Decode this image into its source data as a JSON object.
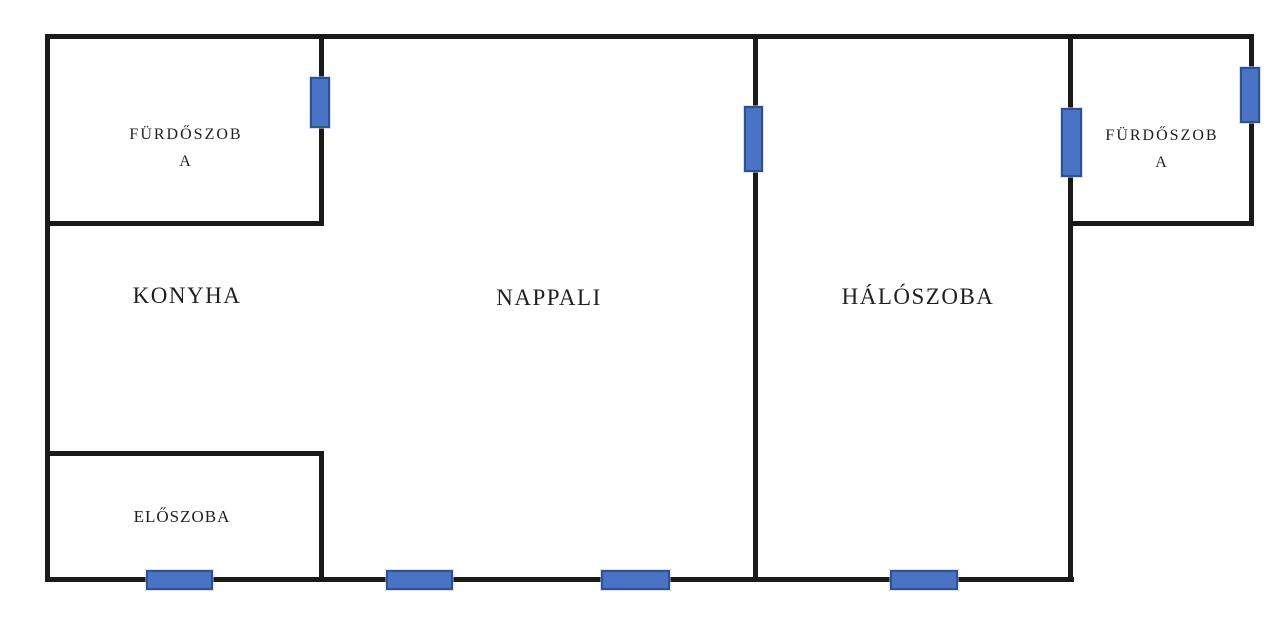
{
  "colors": {
    "wall": "#1a1a1a",
    "door_fill": "#4a72c4",
    "door_border": "#2f528f",
    "bg": "#ffffff",
    "text": "#1f1f1f"
  },
  "rooms": [
    {
      "id": "bathroom-left",
      "label": "FÜRDŐSZOBA",
      "lines": [
        "FÜRDŐSZOB",
        "A"
      ]
    },
    {
      "id": "kitchen",
      "label": "KONYHA"
    },
    {
      "id": "living-room",
      "label": "NAPPALI"
    },
    {
      "id": "bedroom",
      "label": "HÁLÓSZOBA"
    },
    {
      "id": "bathroom-right",
      "label": "FÜRDŐSZOBA",
      "lines": [
        "FÜRDŐSZOB",
        "A"
      ]
    },
    {
      "id": "hallway",
      "label": "ELŐSZOBA"
    }
  ],
  "doors": [
    {
      "id": "door-bathroom-left"
    },
    {
      "id": "door-living-bedroom"
    },
    {
      "id": "door-bedroom-bathroom"
    },
    {
      "id": "window-bathroom-right"
    },
    {
      "id": "door-hall-entry"
    },
    {
      "id": "door-living-1"
    },
    {
      "id": "door-living-2"
    },
    {
      "id": "door-bedroom-bottom"
    }
  ]
}
